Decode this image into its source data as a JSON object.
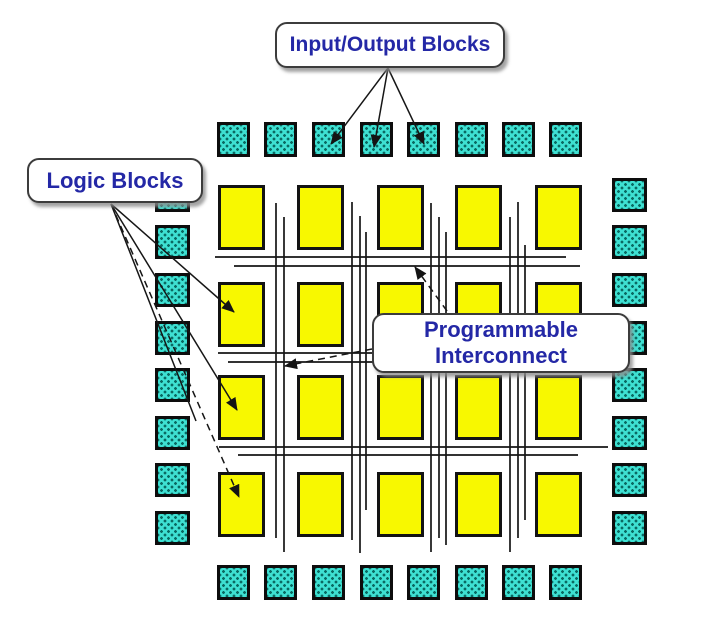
{
  "colors": {
    "bg": "#ffffff",
    "io_fill": "#3ee0d2",
    "io_dot": "#0a6a62",
    "logic_fill": "#f8f800",
    "wire": "#161616",
    "label_color": "#2428a6",
    "box_border": "#3c3c3c",
    "shadow": "rgba(140,140,140,0.8)"
  },
  "diagram": {
    "canvas": {
      "w": 720,
      "h": 621
    },
    "io_groups": [
      {
        "side": "top",
        "xs": [
          217,
          264,
          312,
          360,
          407,
          455,
          502,
          549
        ],
        "ys": [
          122
        ],
        "w": 33,
        "h": 35
      },
      {
        "side": "bottom",
        "xs": [
          217,
          264,
          312,
          360,
          407,
          455,
          502,
          549
        ],
        "ys": [
          565
        ],
        "w": 33,
        "h": 35
      },
      {
        "side": "left",
        "xs": [
          155
        ],
        "ys": [
          178,
          225,
          273,
          321,
          368,
          416,
          463,
          511
        ],
        "w": 35,
        "h": 34
      },
      {
        "side": "right",
        "xs": [
          612
        ],
        "ys": [
          178,
          225,
          273,
          321,
          368,
          416,
          463,
          511
        ],
        "w": 35,
        "h": 34
      }
    ],
    "logic_grid": {
      "xs": [
        218,
        297,
        377,
        455,
        535
      ],
      "ys": [
        185,
        282,
        375,
        472
      ],
      "w": 47,
      "h": 65
    },
    "wires": {
      "v": [
        [
          276,
          203,
          538
        ],
        [
          284,
          217,
          552
        ],
        [
          352,
          202,
          540
        ],
        [
          360,
          216,
          553
        ],
        [
          366,
          232,
          510
        ],
        [
          431,
          203,
          552
        ],
        [
          439,
          217,
          538
        ],
        [
          446,
          232,
          545
        ],
        [
          510,
          217,
          552
        ],
        [
          518,
          202,
          538
        ],
        [
          525,
          245,
          520
        ]
      ],
      "h": [
        [
          257,
          215,
          566
        ],
        [
          266,
          234,
          580
        ],
        [
          353,
          218,
          585
        ],
        [
          362,
          228,
          577
        ],
        [
          447,
          219,
          608
        ],
        [
          455,
          238,
          578
        ]
      ]
    }
  },
  "callouts": [
    {
      "el": "callout-input-output-blocks",
      "lines": [
        "Input/Output Blocks"
      ],
      "box": [
        275,
        22,
        230,
        46
      ],
      "arrows": [
        {
          "from": [
            388,
            68
          ],
          "to": [
            331,
            144
          ],
          "head": true,
          "dashed": false
        },
        {
          "from": [
            388,
            68
          ],
          "to": [
            374,
            147
          ],
          "head": true,
          "dashed": false
        },
        {
          "from": [
            388,
            68
          ],
          "to": [
            424,
            144
          ],
          "head": true,
          "dashed": false
        }
      ]
    },
    {
      "el": "callout-logic-blocks",
      "lines": [
        "Logic Blocks"
      ],
      "box": [
        27,
        158,
        176,
        45
      ],
      "arrows": [
        {
          "from": [
            111,
            204
          ],
          "to": [
            234,
            312
          ],
          "head": true,
          "dashed": false
        },
        {
          "from": [
            111,
            204
          ],
          "to": [
            237,
            410
          ],
          "head": true,
          "dashed": false
        },
        {
          "from": [
            111,
            204
          ],
          "to": [
            239,
            497
          ],
          "head": true,
          "dashed": true
        },
        {
          "from": [
            111,
            204
          ],
          "to": [
            196,
            421
          ],
          "head": false,
          "dashed": false
        }
      ]
    },
    {
      "el": "callout-programmable-interconnect",
      "lines": [
        "Programmable",
        "Interconnect"
      ],
      "box": [
        372,
        313,
        258,
        60
      ],
      "arrows": [
        {
          "from": [
            447,
            311
          ],
          "to": [
            415,
            267
          ],
          "head": true,
          "dashed": true
        },
        {
          "from": [
            372,
            349
          ],
          "to": [
            285,
            366
          ],
          "head": true,
          "dashed": true
        }
      ]
    }
  ]
}
